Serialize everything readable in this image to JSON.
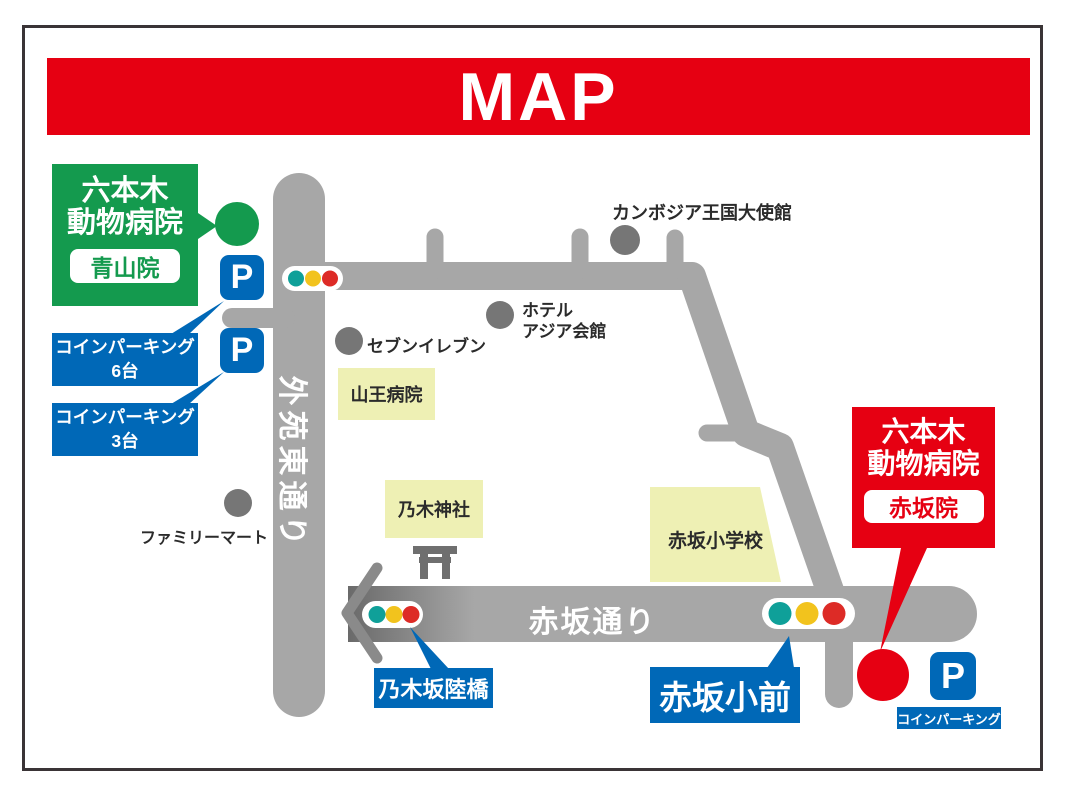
{
  "title": "MAP",
  "colors": {
    "c-red": "#e60012",
    "c-green": "#149a4e",
    "c-blue": "#0068b7",
    "c-road": "#a7a7a7",
    "c-road-dark": "#6a6a6a",
    "c-bracket": "#8a8a8a",
    "c-yellow-box": "#eef0b4",
    "c-gray-circle": "#767676",
    "c-teal": "#0fa099",
    "c-sig-yellow": "#f2c31d",
    "c-sig-red": "#dd2b26",
    "c-text": "#2b2b2b",
    "c-torii": "#6f6f6f"
  },
  "clinic_aoyama": {
    "name_line1": "六本木",
    "name_line2": "動物病院",
    "branch": "青山院"
  },
  "clinic_akasaka": {
    "name_line1": "六本木",
    "name_line2": "動物病院",
    "branch": "赤坂院"
  },
  "roads": {
    "gaien_higashi": "外苑東通り",
    "akasaka_dori": "赤坂通り"
  },
  "landmarks": {
    "seven_eleven": "セブンイレブン",
    "hotel_line1": "ホテル",
    "hotel_line2": "アジア会館",
    "cambodia_embassy": "カンボジア王国大使館",
    "family_mart": "ファミリーマート",
    "sanno_hospital": "山王病院",
    "nogi_shrine": "乃木神社",
    "akasaka_elementary": "赤坂小学校"
  },
  "parking": {
    "p_letter": "P",
    "coin6_line1": "コインパーキング",
    "coin6_line2": "6台",
    "coin3_line1": "コインパーキング",
    "coin3_line2": "3台",
    "coin_akasaka": "コインパーキング"
  },
  "signs": {
    "nogizaka_bridge": "乃木坂陸橋",
    "akasaka_sho_mae": "赤坂小前"
  }
}
